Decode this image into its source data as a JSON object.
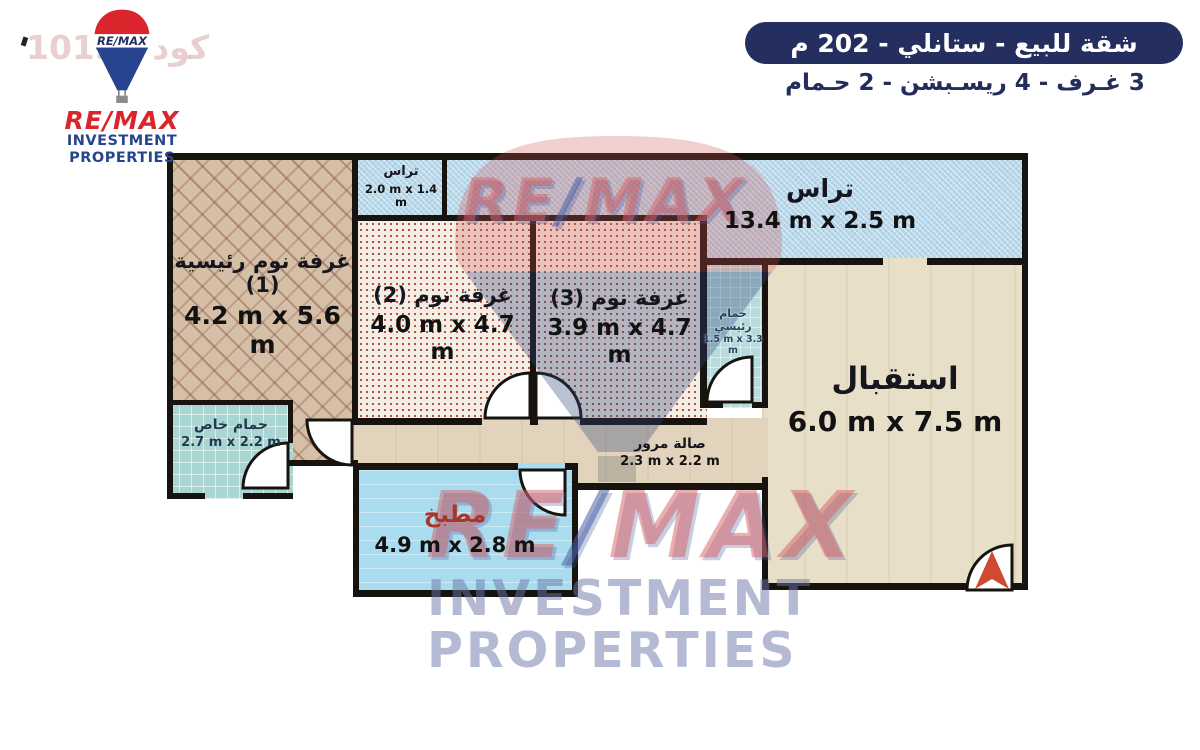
{
  "header": {
    "title": "شقة للبيع - ستانلي - 202 م",
    "subtitle": "3 غـرف - 4 ريسـبشن - 2 حـمام"
  },
  "logo": {
    "balloon_text": "RE/MAX",
    "name": "RE/MAX",
    "line2": "INVESTMENT",
    "line3": "PROPERTIES"
  },
  "watermark": {
    "code": "كود 10158",
    "brand_left": "RE",
    "brand_slash": "/",
    "brand_right": "MAX",
    "line2": "INVESTMENT",
    "line3": "PROPERTIES"
  },
  "colors": {
    "banner_navy": "#242e5f",
    "remax_red": "#d9252b",
    "remax_blue": "#27458e",
    "kitchen_label_red": "#a8372b",
    "entrance_arrow": "#cf4a31",
    "wall_black": "#17130f"
  },
  "rooms": [
    {
      "id": "master-bedroom",
      "label": "غرفة نوم رئيسية (1)",
      "dims": "4.2 m x 5.6 m"
    },
    {
      "id": "terrace-small",
      "label": "تراس",
      "dims": "2.0 m x 1.4 m"
    },
    {
      "id": "terrace-main",
      "label": "تراس",
      "dims": "13.4 m x 2.5 m"
    },
    {
      "id": "bedroom-2",
      "label": "غرفة نوم (2)",
      "dims": "4.0 m x 4.7 m"
    },
    {
      "id": "bedroom-3",
      "label": "غرفة نوم (3)",
      "dims": "3.9 m x 4.7 m"
    },
    {
      "id": "main-bathroom",
      "label": "حمام رئيسي",
      "dims": "1.5 m x 3.3 m"
    },
    {
      "id": "reception",
      "label": "استقبال",
      "dims": "6.0 m x 7.5 m"
    },
    {
      "id": "private-bathroom",
      "label": "حمام خاص",
      "dims": "2.7 m x 2.2 m"
    },
    {
      "id": "hallway",
      "label": "صالة مرور",
      "dims": "2.3 m x 2.2 m"
    },
    {
      "id": "kitchen",
      "label": "مطبخ",
      "dims": "4.9 m x 2.8 m"
    }
  ]
}
